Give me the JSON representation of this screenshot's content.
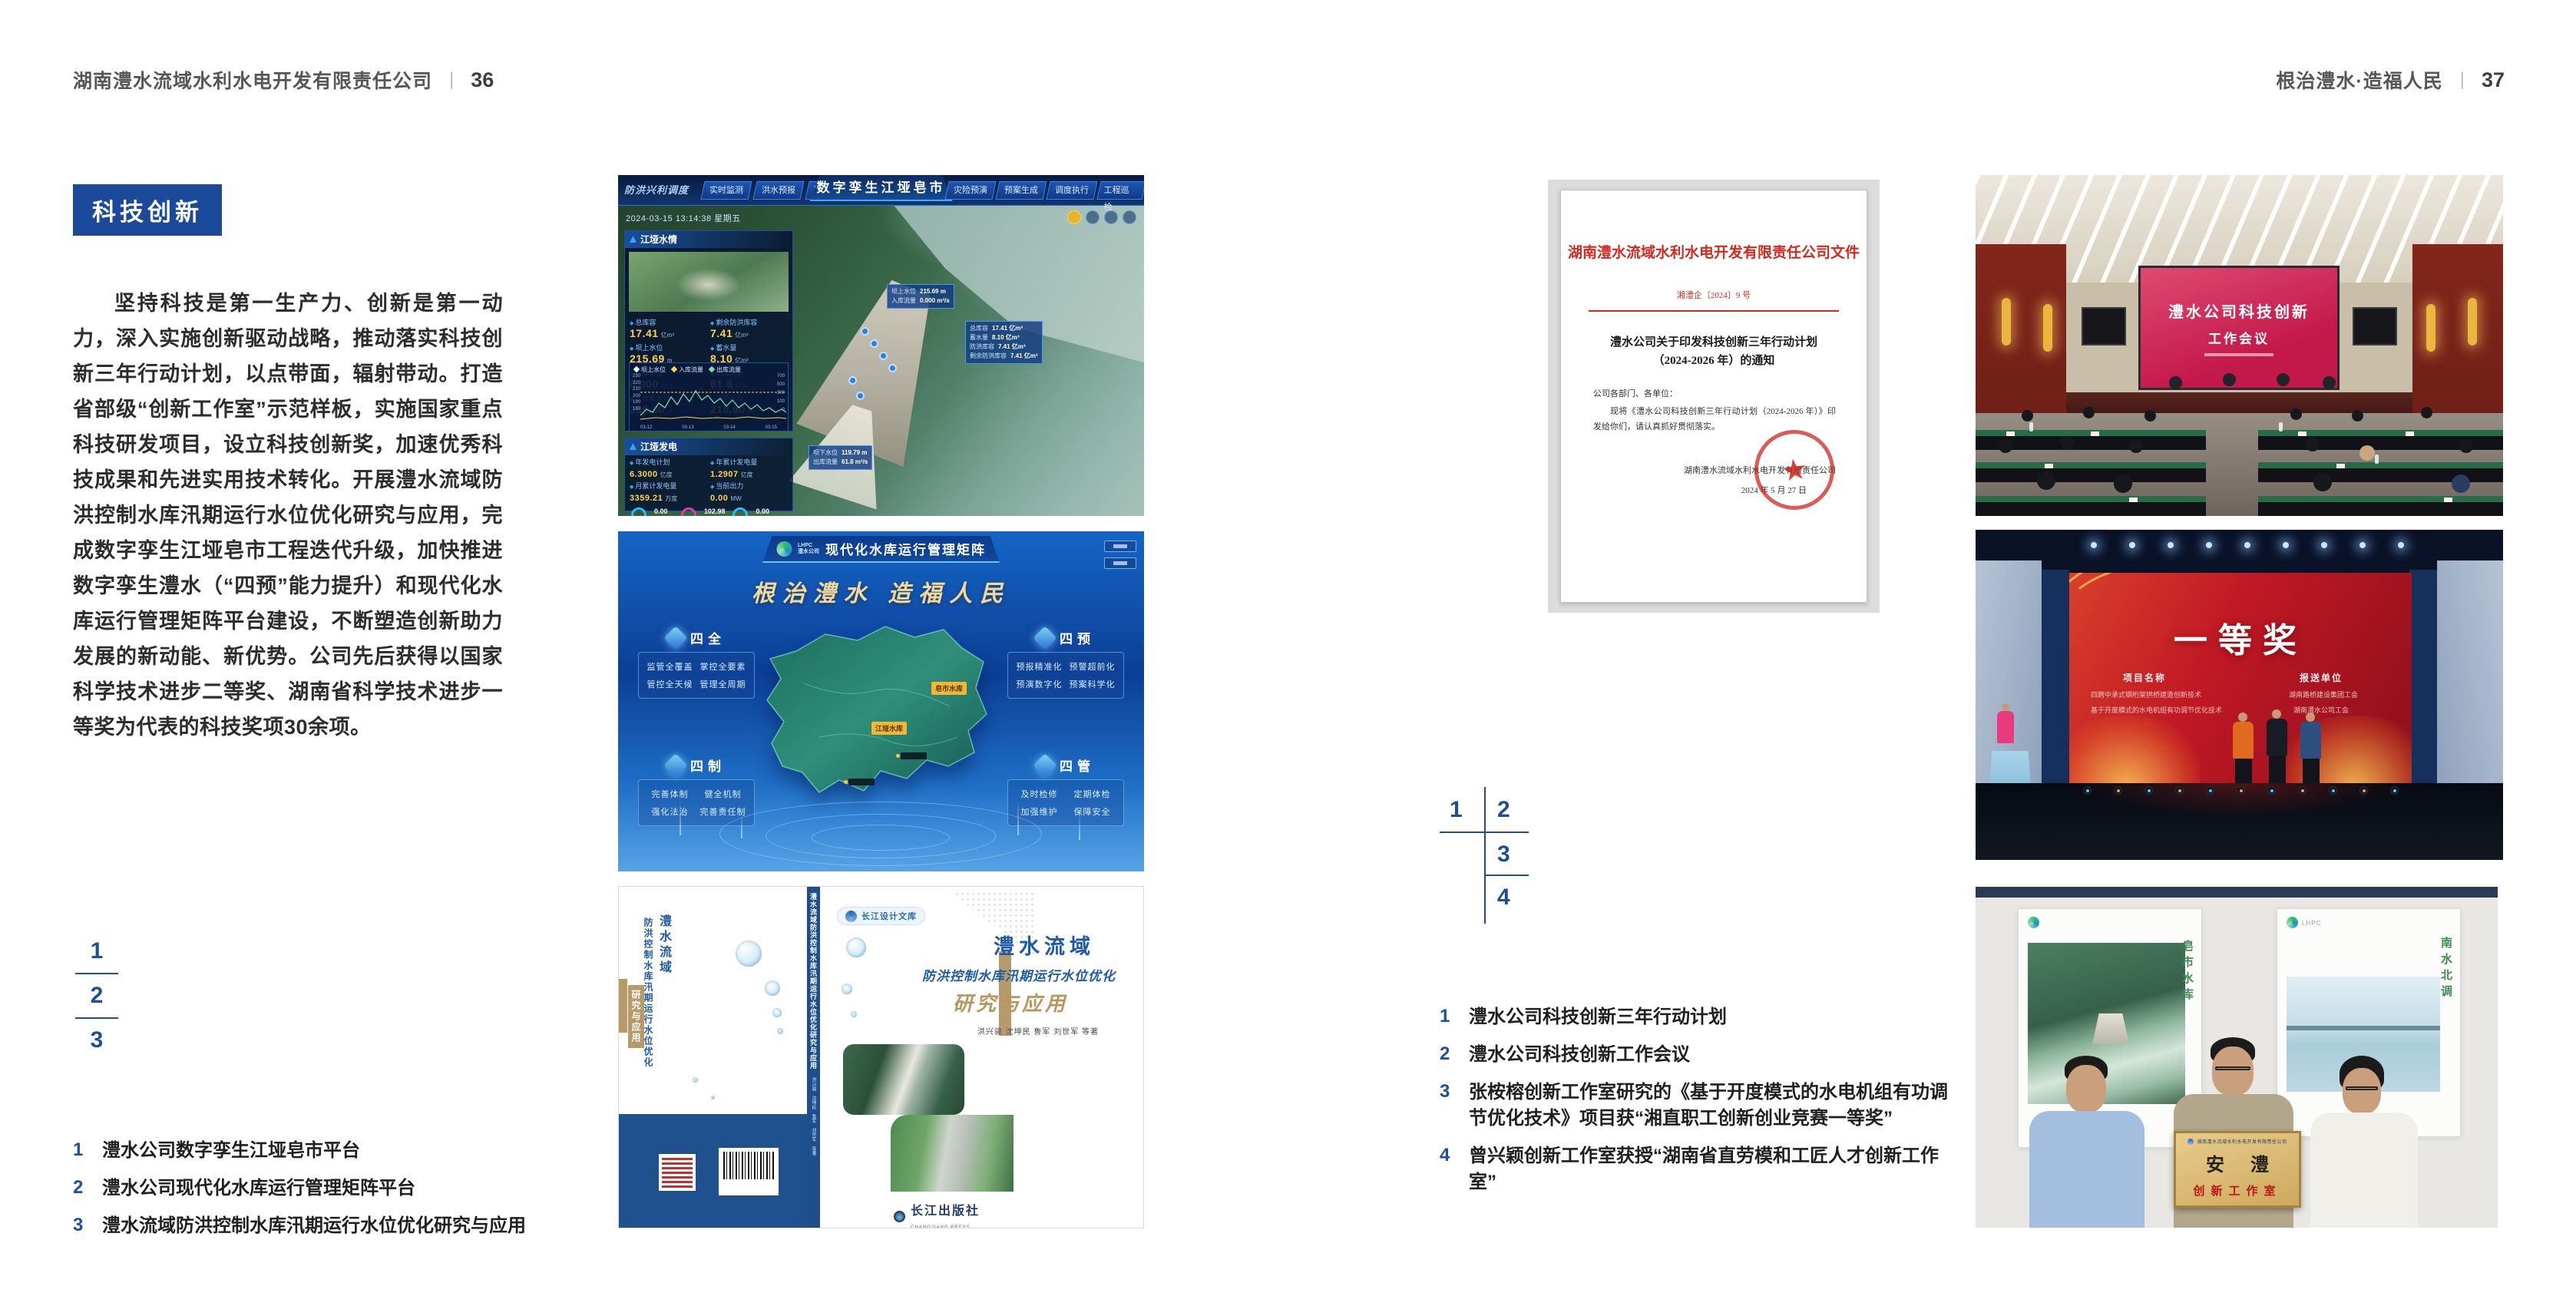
{
  "page_left": {
    "header": {
      "title": "湖南澧水流域水利水电开发有限责任公司",
      "separator": "|",
      "page_number": "36"
    },
    "badge": "科技创新",
    "paragraph": "坚持科技是第一生产力、创新是第一动力，深入实施创新驱动战略，推动落实科技创新三年行动计划，以点带面，辐射带动。打造省部级“创新工作室”示范样板，实施国家重点科技研发项目，设立科技创新奖，加速优秀科技成果和先进实用技术转化。开展澧水流域防洪控制水库汛期运行水位优化研究与应用，完成数字孪生江垭皂市工程迭代升级，加快推进数字孪生澧水（“四预”能力提升）和现代化水库运行管理矩阵平台建设，不断塑造创新助力发展的新动能、新优势。公司先后获得以国家科学技术进步二等奖、湖南省科学技术进步一等奖为代表的科技奖项30余项。",
    "figure_markers": [
      "1",
      "2",
      "3"
    ],
    "captions": [
      {
        "num": "1",
        "text": "澧水公司数字孪生江垭皂市平台"
      },
      {
        "num": "2",
        "text": "澧水公司现代化水库运行管理矩阵平台"
      },
      {
        "num": "3",
        "text": "澧水流域防洪控制水库汛期运行水位优化研究与应用"
      }
    ]
  },
  "page_right": {
    "header": {
      "title": "根治澧水·造福人民",
      "separator": "|",
      "page_number": "37"
    },
    "figure_markers": [
      "1",
      "2",
      "3",
      "4"
    ],
    "captions": [
      {
        "num": "1",
        "text": "澧水公司科技创新三年行动计划"
      },
      {
        "num": "2",
        "text": "澧水公司科技创新工作会议"
      },
      {
        "num": "3",
        "text": "张桉榕创新工作室研究的《基于开度模式的水电机组有功调节优化技术》项目获“湘直职工创新创业竞赛一等奖”"
      },
      {
        "num": "4",
        "text": "曾兴颖创新工作室获授“湖南省直劳模和工匠人才创新工作室”"
      }
    ]
  },
  "fig_dashboard": {
    "title": "数字孪生江垭皂市",
    "module_label": "防洪兴利调度",
    "tabs_left": [
      "实时监测",
      "洪水预报",
      "防洪预警"
    ],
    "tabs_right": [
      "灾险预演",
      "预案生成",
      "调度执行",
      "工程巡检"
    ],
    "timestamp": "2024-03-15 13:14:38 星期五",
    "panel1": {
      "title": "江垭水情",
      "stats": [
        {
          "label": "总库容",
          "value": "17.41",
          "unit": "亿m³"
        },
        {
          "label": "剩余防洪库容",
          "value": "7.41",
          "unit": "亿m³"
        },
        {
          "label": "坝上水位",
          "value": "215.69",
          "unit": "m"
        },
        {
          "label": "蓄水量",
          "value": "8.10",
          "unit": "亿m³"
        },
        {
          "label": "入库流量",
          "value": "0.000",
          "unit": "m³/s"
        },
        {
          "label": "出库流量",
          "value": "61.8",
          "unit": "m³/s"
        },
        {
          "label": "正常蓄水位",
          "value": "236.00",
          "unit": "m"
        },
        {
          "label": "汛限水位",
          "value": "210.60",
          "unit": "m"
        }
      ],
      "chart": {
        "legend": [
          "坝上水位",
          "入库流量",
          "出库流量"
        ],
        "y_left": [
          "230",
          "220",
          "210",
          "200",
          "190",
          "180"
        ],
        "y_right": [
          "700",
          "500",
          "300",
          "100",
          "0"
        ],
        "x_ticks": [
          "03-12",
          "03-13",
          "03-14",
          "03-15"
        ],
        "points_level": "0,50 8,42 16,46 24,34 32,40 40,26 48,36 56,22 64,32 72,18 80,30 88,24 96,34 104,28 112,38 120,30 128,40 136,34 144,42 152,36 160,44 168,40 176,46 184,42 190,46",
        "points_outflow": "0,55 20,53 40,54 60,52 80,54 100,53 120,54 140,52 160,54 180,53 190,54",
        "points_threshold": "0,20 190,20"
      }
    },
    "panel2": {
      "title": "江垭发电",
      "stats": [
        {
          "label": "年发电计划",
          "value": "6.3000",
          "unit": "亿度"
        },
        {
          "label": "年累计发电量",
          "value": "1.2907",
          "unit": "亿度"
        },
        {
          "label": "月累计发电量",
          "value": "3359.21",
          "unit": "万度"
        },
        {
          "label": "当前出力",
          "value": "0.00",
          "unit": "MW"
        },
        {
          "label": "发电流量",
          "value": "0.00",
          "unit": "m³/s"
        },
        {
          "label": "弃水流量",
          "value": "0.00",
          "unit": "m³/s"
        }
      ],
      "gauges": [
        {
          "value": "0.00",
          "label": "1号机组"
        },
        {
          "value": "102.98",
          "label": "2号机组"
        },
        {
          "value": "0.00",
          "label": "3号机组"
        }
      ]
    },
    "tag_upstream": {
      "rows": [
        {
          "label": "坝上水位",
          "value": "215.69 m"
        },
        {
          "label": "入库流量",
          "value": "0.000 m³/s"
        }
      ]
    },
    "tag_capacity": {
      "rows": [
        {
          "label": "总库容",
          "value": "17.41 亿m³"
        },
        {
          "label": "蓄水量",
          "value": "8.10 亿m³"
        },
        {
          "label": "防洪库容",
          "value": "7.41 亿m³"
        },
        {
          "label": "剩余防洪库容",
          "value": "7.41 亿m³"
        }
      ]
    },
    "tag_downstream": {
      "rows": [
        {
          "label": "坝下水位",
          "value": "119.79 m"
        },
        {
          "label": "出库流量",
          "value": "61.8 m³/s"
        }
      ]
    }
  },
  "fig_matrix": {
    "logo_en": "LHPC",
    "logo_cn": "澧水公司",
    "title": "现代化水库运行管理矩阵",
    "slogan": "根治澧水 造福人民",
    "panels": [
      {
        "title": "四全",
        "items": [
          "监管全覆盖",
          "掌控全要素",
          "管控全天候",
          "管理全周期"
        ]
      },
      {
        "title": "四预",
        "items": [
          "预报精准化",
          "预警超前化",
          "预演数字化",
          "预案科学化"
        ]
      },
      {
        "title": "四制",
        "items": [
          "完善体制",
          "健全机制",
          "强化法治",
          "完善责任制"
        ]
      },
      {
        "title": "四管",
        "items": [
          "及时检修",
          "定期体检",
          "加强维护",
          "保障安全"
        ]
      }
    ],
    "markers": [
      {
        "label": "皂市水库"
      },
      {
        "label": "江垭水库"
      }
    ]
  },
  "fig_book": {
    "series": "长江设计文库",
    "title_line1": "澧水流域",
    "title_line2": "防洪控制水库汛期运行水位优化",
    "title_line3": "研究与应用",
    "authors": "洪兴骏 沈坤民 鲁军 刘世军 等著",
    "spine_title": "澧水流域防洪控制水库汛期运行水位优化研究与应用",
    "spine_authors": "洪兴骏 沈坤民 鲁军 刘世军 等著",
    "publisher": "长江出版社",
    "publisher_en": "CHANGJIANG PRESS"
  },
  "fig_document": {
    "header": "湖南澧水流域水利水电开发有限责任公司文件",
    "doc_no": "湘澧企〔2024〕9 号",
    "title": "澧水公司关于印发科技创新三年行动计划（2024-2026 年）的通知",
    "salutation": "公司各部门、各单位：",
    "body": "现将《澧水公司科技创新三年行动计划（2024-2026 年）》印发给你们，请认真抓好贯彻落实。",
    "signer": "湖南澧水流域水利水电开发有限责任公司",
    "date": "2024 年 5 月 27 日",
    "seal_star": "★"
  },
  "fig_meeting": {
    "screen_line1": "澧水公司科技创新",
    "screen_line2": "工作会议"
  },
  "fig_stage": {
    "award": "一等奖",
    "col1_header": "项目名称",
    "col1_rows": [
      "四跨中承式钢桁架拱桥建造创新技术",
      "基于开度模式的水电机组有功调节优化技术"
    ],
    "col2_header": "报送单位",
    "col2_rows": [
      "湖南路桥建设集团工会",
      "湖南澧水公司工会"
    ]
  },
  "fig_award": {
    "poster_left_text": "皂市水库",
    "poster_right_text": "南水北调",
    "plaque_header": "湖南澧水流域水利水电开发有限责任公司",
    "plaque_title": "安澧",
    "plaque_subtitle": "创新工作室"
  }
}
